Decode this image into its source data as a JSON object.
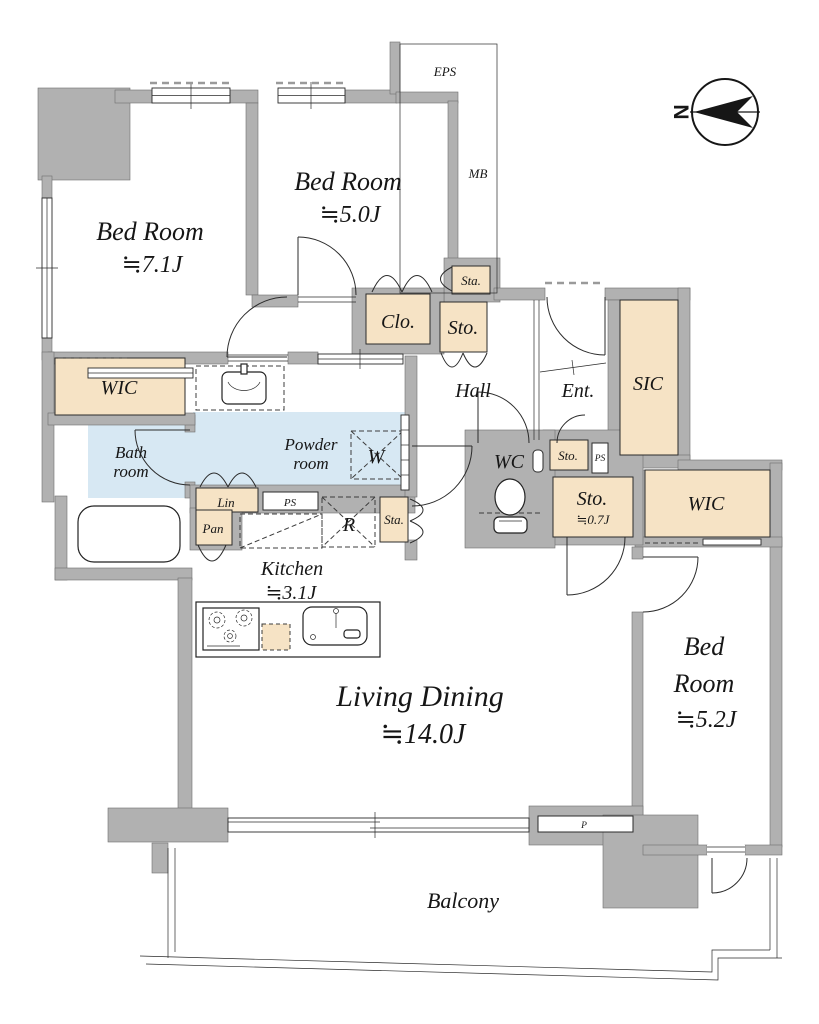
{
  "colors": {
    "wall_gray": "#b1b1b1",
    "room_beige": "#f6e3c5",
    "wet_area_blue": "#d7e8f3",
    "line": "#2b2b2b"
  },
  "rooms": {
    "bedroom_west": {
      "name": "Bed Room",
      "size": "≒7.1J"
    },
    "bedroom_north": {
      "name": "Bed Room",
      "size": "≒5.0J"
    },
    "bedroom_east": {
      "name_line1": "Bed",
      "name_line2": "Room",
      "size": "≒5.2J"
    },
    "living_dining": {
      "name": "Living Dining",
      "size": "≒14.0J"
    },
    "kitchen": {
      "name": "Kitchen",
      "size": "≒3.1J"
    },
    "powder_room": {
      "name_line1": "Powder",
      "name_line2": "room"
    },
    "bath_room": {
      "name_line1": "Bath",
      "name_line2": "room"
    },
    "wc": {
      "name": "WC"
    },
    "hall": {
      "name": "Hall"
    },
    "entrance": {
      "name": "Ent."
    },
    "sic": {
      "name": "SIC"
    },
    "wic_west": {
      "name": "WIC"
    },
    "wic_east": {
      "name": "WIC"
    },
    "closet": {
      "name": "Clo."
    },
    "storage_hall": {
      "name": "Sto."
    },
    "storage_north_small": {
      "name": "Sta."
    },
    "storage_entrance": {
      "name": "Sto."
    },
    "storage_07": {
      "name": "Sto.",
      "size": "≒0.7J"
    },
    "storage_kitchen_small": {
      "name": "Sta."
    },
    "linen": {
      "name": "Lin"
    },
    "pantry": {
      "name": "Pan"
    },
    "balcony": {
      "name": "Balcony"
    }
  },
  "labels": {
    "eps": "EPS",
    "mb": "MB",
    "ps_powder": "PS",
    "ps_entrance": "PS",
    "pipe_duct": "P",
    "washer": "W",
    "refrigerator": "R",
    "north": "N"
  }
}
